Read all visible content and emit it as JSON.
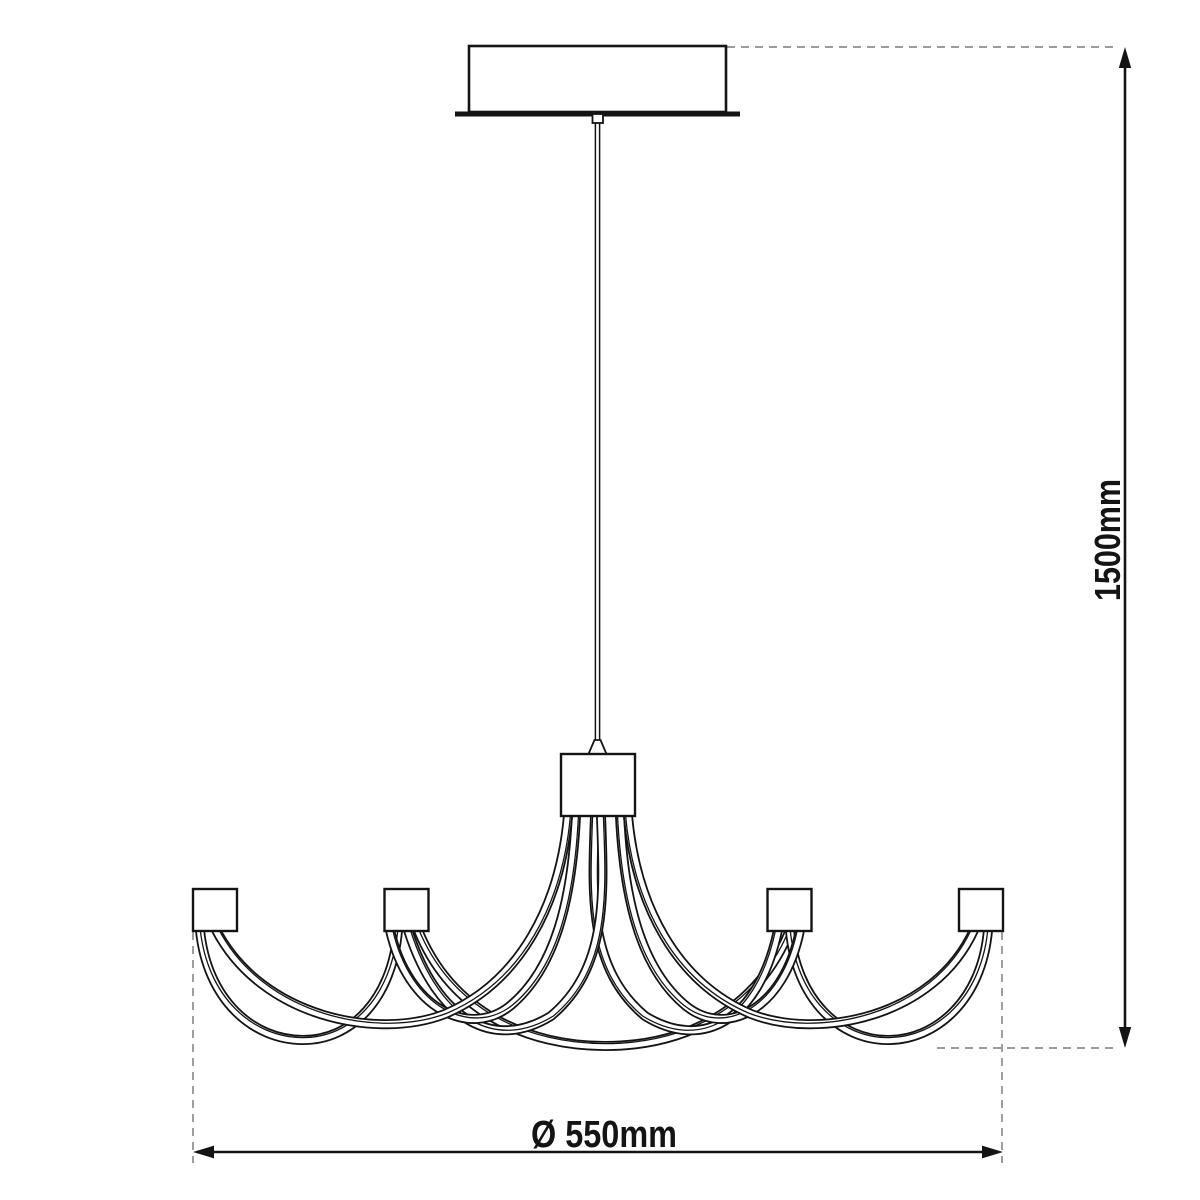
{
  "drawing": {
    "background": "#ffffff",
    "ink_color": "#141414",
    "extension_line_color": "#8e8e8e",
    "labels": {
      "height": "1500mm",
      "diameter": "Ø 550mm"
    }
  }
}
